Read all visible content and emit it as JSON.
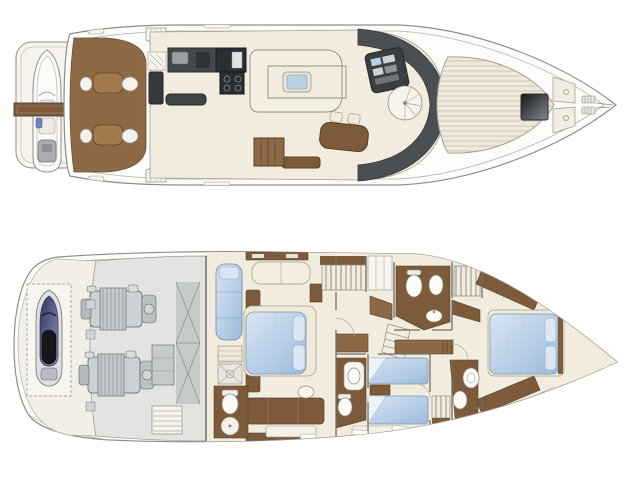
{
  "canvas": {
    "width": 642,
    "height": 481,
    "background": "#ffffff"
  },
  "palette": {
    "background": "#ffffff",
    "outline": "#8e8e88",
    "outline_soft": "#b3b1a8",
    "hull_white": "#fcfcfa",
    "deck_cream": "#f1ecdd",
    "cream_light": "#f6f4ec",
    "garage_cream": "#f2efe6",
    "teak": "#8d6a45",
    "teak_table": "#a17a4e",
    "wood": "#7d5a3a",
    "wood_mid": "#8b6947",
    "counter_dark": "#43484b",
    "appliance_black": "#2a2e30",
    "charcoal": "#4b4f51",
    "glass_blue": "#b9cfe2",
    "bed_blue": "#9bbadc",
    "bed_blue_light": "#d9e6f2",
    "engine_room": "#e2e4e1",
    "machinery": "#ccd1d3",
    "tank": "#c6cac7",
    "jetski_dark": "#2f355f",
    "jetski_light": "#8f94bd",
    "seat_black": "#17171a",
    "stripe": "#c9c3b2",
    "fixture_white": "#fbfbf8",
    "wall": "#6f6f68"
  },
  "plans": {
    "main_deck": {
      "id": "main-deck",
      "position": "top",
      "rooms": [
        "swim-platform",
        "tender",
        "passerelle",
        "cockpit",
        "galley",
        "salon",
        "dinette",
        "companionway",
        "helm-station",
        "spiral-staircase",
        "windshield",
        "foredeck-sunpad",
        "deck-hatch",
        "bow-seating",
        "anchor-gear"
      ]
    },
    "lower_deck": {
      "id": "lower-deck",
      "position": "bottom",
      "rooms": [
        "garage-jetski",
        "engine-room",
        "fuel-tank",
        "engine-room-stairs",
        "master-cabin",
        "master-ensuite",
        "wardrobe",
        "corridor-staircase",
        "day-head",
        "twin-cabin",
        "twin-ensuite",
        "vip-cabin",
        "vip-ensuite"
      ]
    }
  }
}
